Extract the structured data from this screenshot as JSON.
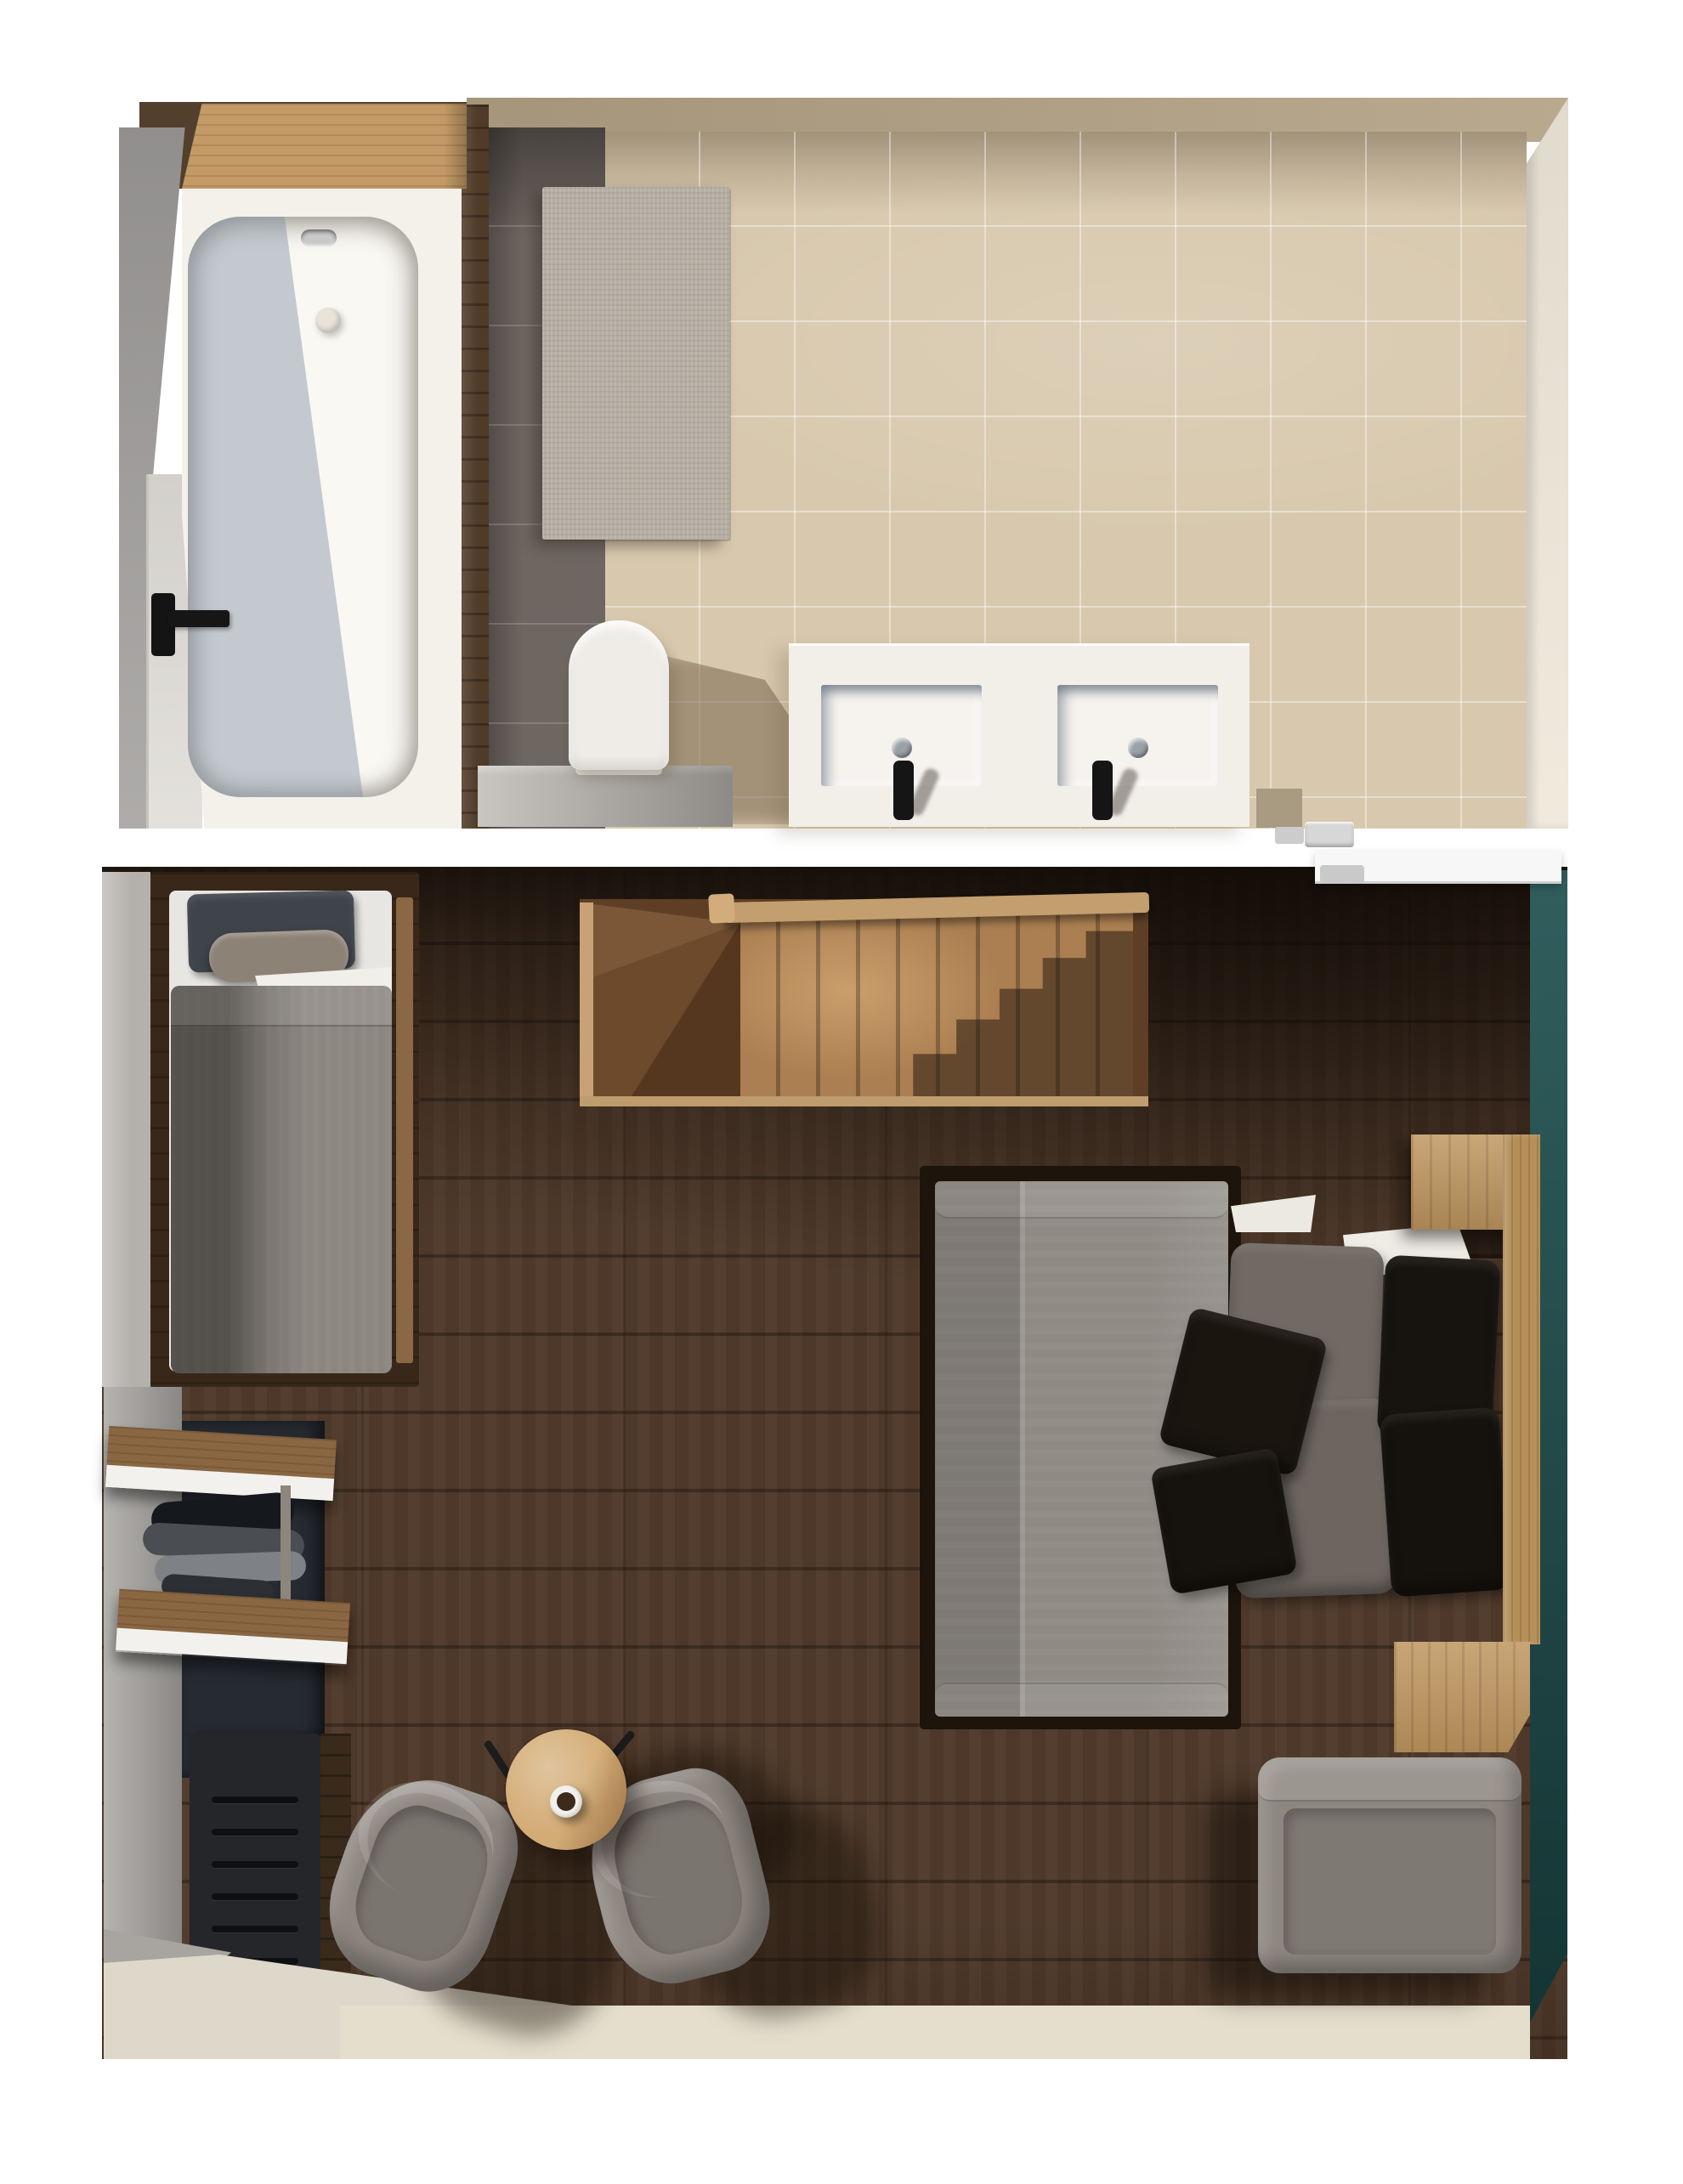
{
  "meta": {
    "type": "3d-rendered-floor-plan-top-view",
    "rooms": [
      "bathroom",
      "bedroom"
    ],
    "visible_text": "none"
  },
  "palette": {
    "background_white": "#ffffff",
    "wall_tan": "#b3a285",
    "tile_beige": "#d8c9ae",
    "tile_dark_gray": "#6e6660",
    "wood_trim_dark": "#503b28",
    "shelf_wood_light": "#c39a66",
    "wall_gray": "#a5a2a0",
    "door_leaf_gray": "#e0ddd8",
    "handle_black": "#141414",
    "tub_white": "#faf8f3",
    "tub_surround_white": "#f4f1ea",
    "mat_gray": "#b5aea3",
    "porcelain_white": "#efece7",
    "bench_concrete": "#b6b2ac",
    "vanity_white": "#f2efe9",
    "faucet_black": "#151515",
    "cream_wall": "#efe8da",
    "chrome": "#d7d7d7",
    "floor_walnut": "#503a2b",
    "accent_teal": "#1f5150",
    "door_white": "#f7f7f7",
    "door_handle_gray": "#c9c9c9",
    "stair_wood": "#ab7f51",
    "stair_winder_brown": "#6d4a2c",
    "handrail_wood": "#c39e6e",
    "bed_frame_walnut": "#39281a",
    "mattress_white": "#e8e6e2",
    "pillow_charcoal": "#3f434a",
    "bolster_taupe": "#8d8276",
    "duvet_gray": "#8b8680",
    "wardrobe_navy": "#262a31",
    "shelf_wood": "#8a6742",
    "shelf_white": "#f2f1ed",
    "radiator_black": "#24262a",
    "floor_beige_strip": "#e6decd",
    "chair_gray": "#8e8780",
    "table_oak": "#d3ab74",
    "coffee_brown": "#3c2b1d",
    "double_duvet_gray": "#8f8a84",
    "double_frame_dark": "#1d140c",
    "pillow_gray": "#716a64",
    "pillow_black": "#17130e",
    "nightstand_oak": "#c09760",
    "headboard_oak": "#b68f58",
    "ottoman_gray": "#8e8780",
    "sheet_white": "#efece5"
  },
  "bathroom": {
    "name": "bathroom",
    "objects": [
      "sloped-side-wall",
      "entry-door",
      "door-handle",
      "wood-shelf",
      "bathtub",
      "tub-overflow",
      "tub-drain",
      "dark-tile-strip",
      "bath-mat",
      "beige-tile-floor",
      "toilet",
      "concrete-cistern-bench",
      "double-vanity",
      "basin-left",
      "basin-right",
      "drain-left",
      "drain-right",
      "faucet-left",
      "faucet-right",
      "right-cream-wall",
      "door-hinge-hardware"
    ]
  },
  "bedroom": {
    "name": "bedroom",
    "objects": [
      "walnut-floor",
      "teal-accent-wall",
      "entry-door",
      "door-handle",
      "staircase-winder",
      "staircase-treads",
      "handrail",
      "single-bed",
      "single-bed-pillow",
      "single-bed-bolster",
      "single-bed-duvet",
      "wardrobe-shelves",
      "hanging-clothes",
      "clothes-rail",
      "radiator",
      "armchair-left",
      "armchair-right",
      "coffee-table",
      "coffee-cup",
      "double-bed",
      "double-bed-duvet",
      "gray-pillows",
      "black-pillows",
      "throw-pillows",
      "nightstand",
      "headboard-panel",
      "dresser",
      "ottoman",
      "beige-floor-strip"
    ]
  }
}
